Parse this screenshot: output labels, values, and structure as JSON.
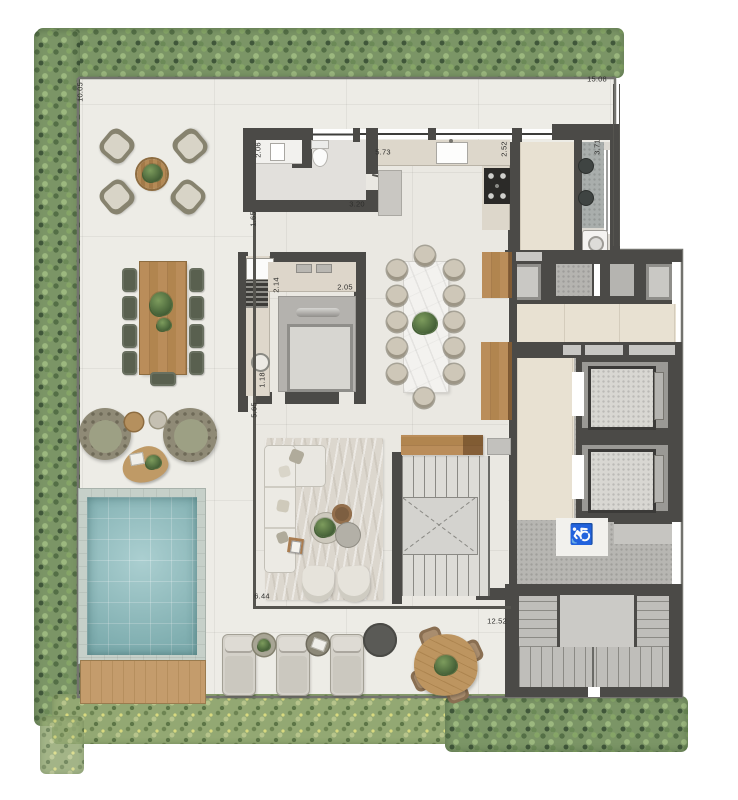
{
  "plan": {
    "type": "residential-floor-plan",
    "dimension_labels": [
      {
        "value": "10.05",
        "x": 80,
        "y": 92,
        "vertical": true
      },
      {
        "value": "15.08",
        "x": 597,
        "y": 79,
        "vertical": false
      },
      {
        "value": "2.06",
        "x": 258,
        "y": 150,
        "vertical": true
      },
      {
        "value": "5.73",
        "x": 383,
        "y": 152,
        "vertical": false
      },
      {
        "value": "3.20",
        "x": 357,
        "y": 204,
        "vertical": false
      },
      {
        "value": "2.52",
        "x": 504,
        "y": 149,
        "vertical": true
      },
      {
        "value": "3.71",
        "x": 597,
        "y": 147,
        "vertical": true
      },
      {
        "value": "1.65",
        "x": 253,
        "y": 219,
        "vertical": true
      },
      {
        "value": "2.14",
        "x": 276,
        "y": 285,
        "vertical": true
      },
      {
        "value": "2.05",
        "x": 345,
        "y": 287,
        "vertical": false
      },
      {
        "value": "1.18",
        "x": 262,
        "y": 380,
        "vertical": true
      },
      {
        "value": "5.65",
        "x": 254,
        "y": 410,
        "vertical": true
      },
      {
        "value": "6.44",
        "x": 262,
        "y": 596,
        "vertical": false
      },
      {
        "value": "12.52",
        "x": 497,
        "y": 621,
        "vertical": false
      }
    ],
    "icons": {
      "accessibility": "♿"
    },
    "colors": {
      "wall": "#4b4a47",
      "terrace_floor": "#edece6",
      "interior_floor": "#eae8e2",
      "hall_tile": "#e8e1d2",
      "concrete": "#b7b6b2",
      "pool_water": "#8fbfc1",
      "deck_wood": "#c49c6c",
      "hedge_green": "#7b9566",
      "marble": "#f3f2ef",
      "furniture_wood": "#b68a58"
    }
  }
}
